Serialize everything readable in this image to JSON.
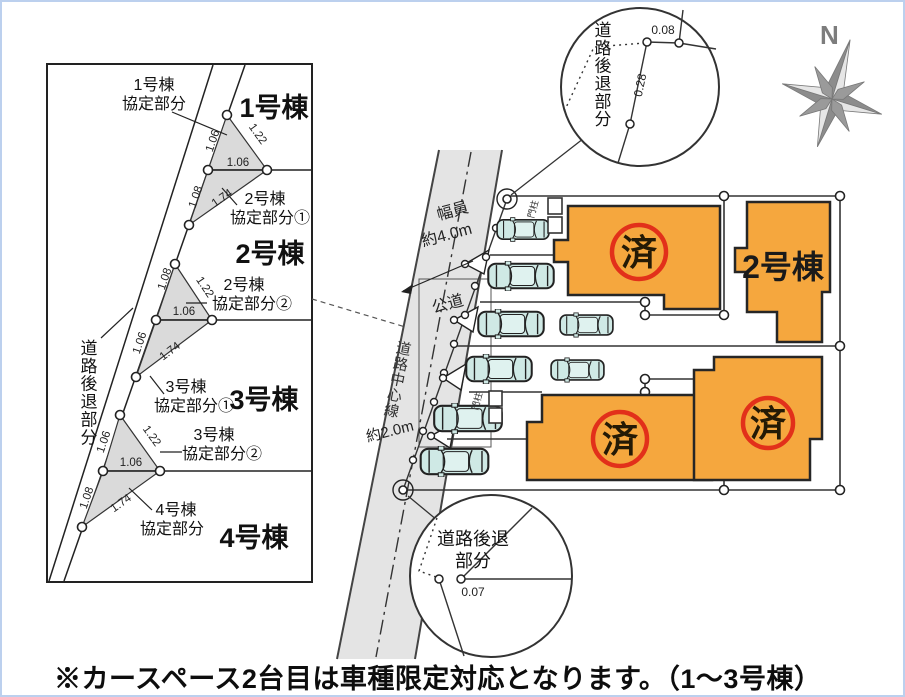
{
  "note": "※カースペース2台目は車種限定対応となります。（1～3号棟）",
  "compass": {
    "north": "N"
  },
  "left_panel": {
    "setback_label": "道路後退部分",
    "lots": [
      {
        "label": "1号棟"
      },
      {
        "label": "2号棟"
      },
      {
        "label": "3号棟"
      },
      {
        "label": "4号棟"
      }
    ],
    "agreements": [
      {
        "line1": "1号棟",
        "line2": "協定部分"
      },
      {
        "line1": "2号棟",
        "line2": "協定部分①"
      },
      {
        "line1": "2号棟",
        "line2": "協定部分②"
      },
      {
        "line1": "3号棟",
        "line2": "協定部分①"
      },
      {
        "line1": "3号棟",
        "line2": "協定部分②"
      },
      {
        "line1": "4号棟",
        "line2": "協定部分"
      }
    ],
    "measurements": [
      "1.06",
      "1.22",
      "1.06",
      "1.08",
      "1.74",
      "1.08",
      "1.22",
      "1.06",
      "1.06",
      "1.74",
      "1.06",
      "1.22",
      "1.06",
      "1.08",
      "1.74"
    ]
  },
  "site_plan": {
    "road": {
      "width_line1": "幅員",
      "width_line2": "約4.0m",
      "public_road": "公道",
      "centerline": "道路中心線",
      "half_width": "約2.0m"
    },
    "gate_post_label": "門柱",
    "buildings": [
      {
        "id": "1",
        "status": "済"
      },
      {
        "id": "2",
        "label": "2号棟"
      },
      {
        "id": "3",
        "status": "済"
      },
      {
        "id": "4",
        "status": "済"
      }
    ]
  },
  "callouts": {
    "top": {
      "label": "道路後退部分",
      "dim1": "0.08",
      "dim2": "0.28"
    },
    "bottom": {
      "label_line1": "道路後退",
      "label_line2": "部分",
      "dim": "0.07"
    }
  },
  "colors": {
    "building": "#F5A73E",
    "sold_ring": "#E2301A",
    "car": "#CFE9E5",
    "road": "#E4E4E4"
  }
}
